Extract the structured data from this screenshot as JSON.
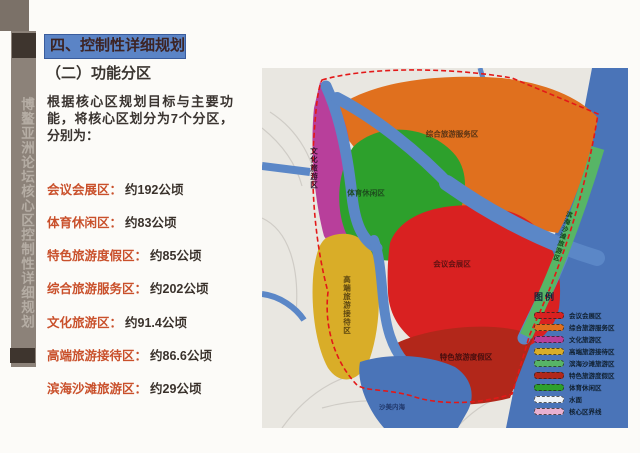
{
  "sidebar": {
    "vertical_text": "博鳌亚洲论坛核心区控制性详细规划"
  },
  "header": {
    "title": "四、控制性详细规划",
    "subtitle": "（二）功能分区"
  },
  "intro": {
    "text": "根据核心区规划目标与主要功能，将核心区划分为7个分区，分别为："
  },
  "zones": [
    {
      "label": "会议会展区：",
      "value": "约192公顷"
    },
    {
      "label": "体育休闲区：",
      "value": "约83公顷"
    },
    {
      "label": "特色旅游度假区：",
      "value": "约85公顷"
    },
    {
      "label": "综合旅游服务区：",
      "value": "约202公顷"
    },
    {
      "label": "文化旅游区：",
      "value": "约91.4公顷"
    },
    {
      "label": "高端旅游接待区：",
      "value": "约86.6公顷"
    },
    {
      "label": "滨海沙滩旅游区：",
      "value": "约29公顷"
    }
  ],
  "map": {
    "labels": {
      "comprehensive": "综合旅游服务区",
      "culture": "文化旅游区",
      "sports": "体育休闲区",
      "conference": "会议会展区",
      "featured": "特色旅游度假区",
      "highend": "高端旅游接待区",
      "beach": "滨海沙滩旅游区",
      "water": "沙美内海"
    },
    "legend": {
      "title": "图例",
      "items": [
        {
          "label": "会议会展区",
          "color": "#d92121"
        },
        {
          "label": "综合旅游服务区",
          "color": "#e0701e"
        },
        {
          "label": "文化旅游区",
          "color": "#b83f9b"
        },
        {
          "label": "高端旅游接待区",
          "color": "#d9ad28"
        },
        {
          "label": "滨海沙滩旅游区",
          "color": "#57b566"
        },
        {
          "label": "特色旅游度假区",
          "color": "#b2271a"
        },
        {
          "label": "体育休闲区",
          "color": "#2da02c"
        },
        {
          "label": "水面",
          "color": "#eef2f8"
        },
        {
          "label": "核心区界线",
          "color": "#e8b0d0"
        }
      ]
    }
  },
  "colors": {
    "accent_red": "#c9502b",
    "title_bg": "#5b84c6",
    "water_blue": "#4a74b8",
    "boundary_red": "#e31818"
  }
}
